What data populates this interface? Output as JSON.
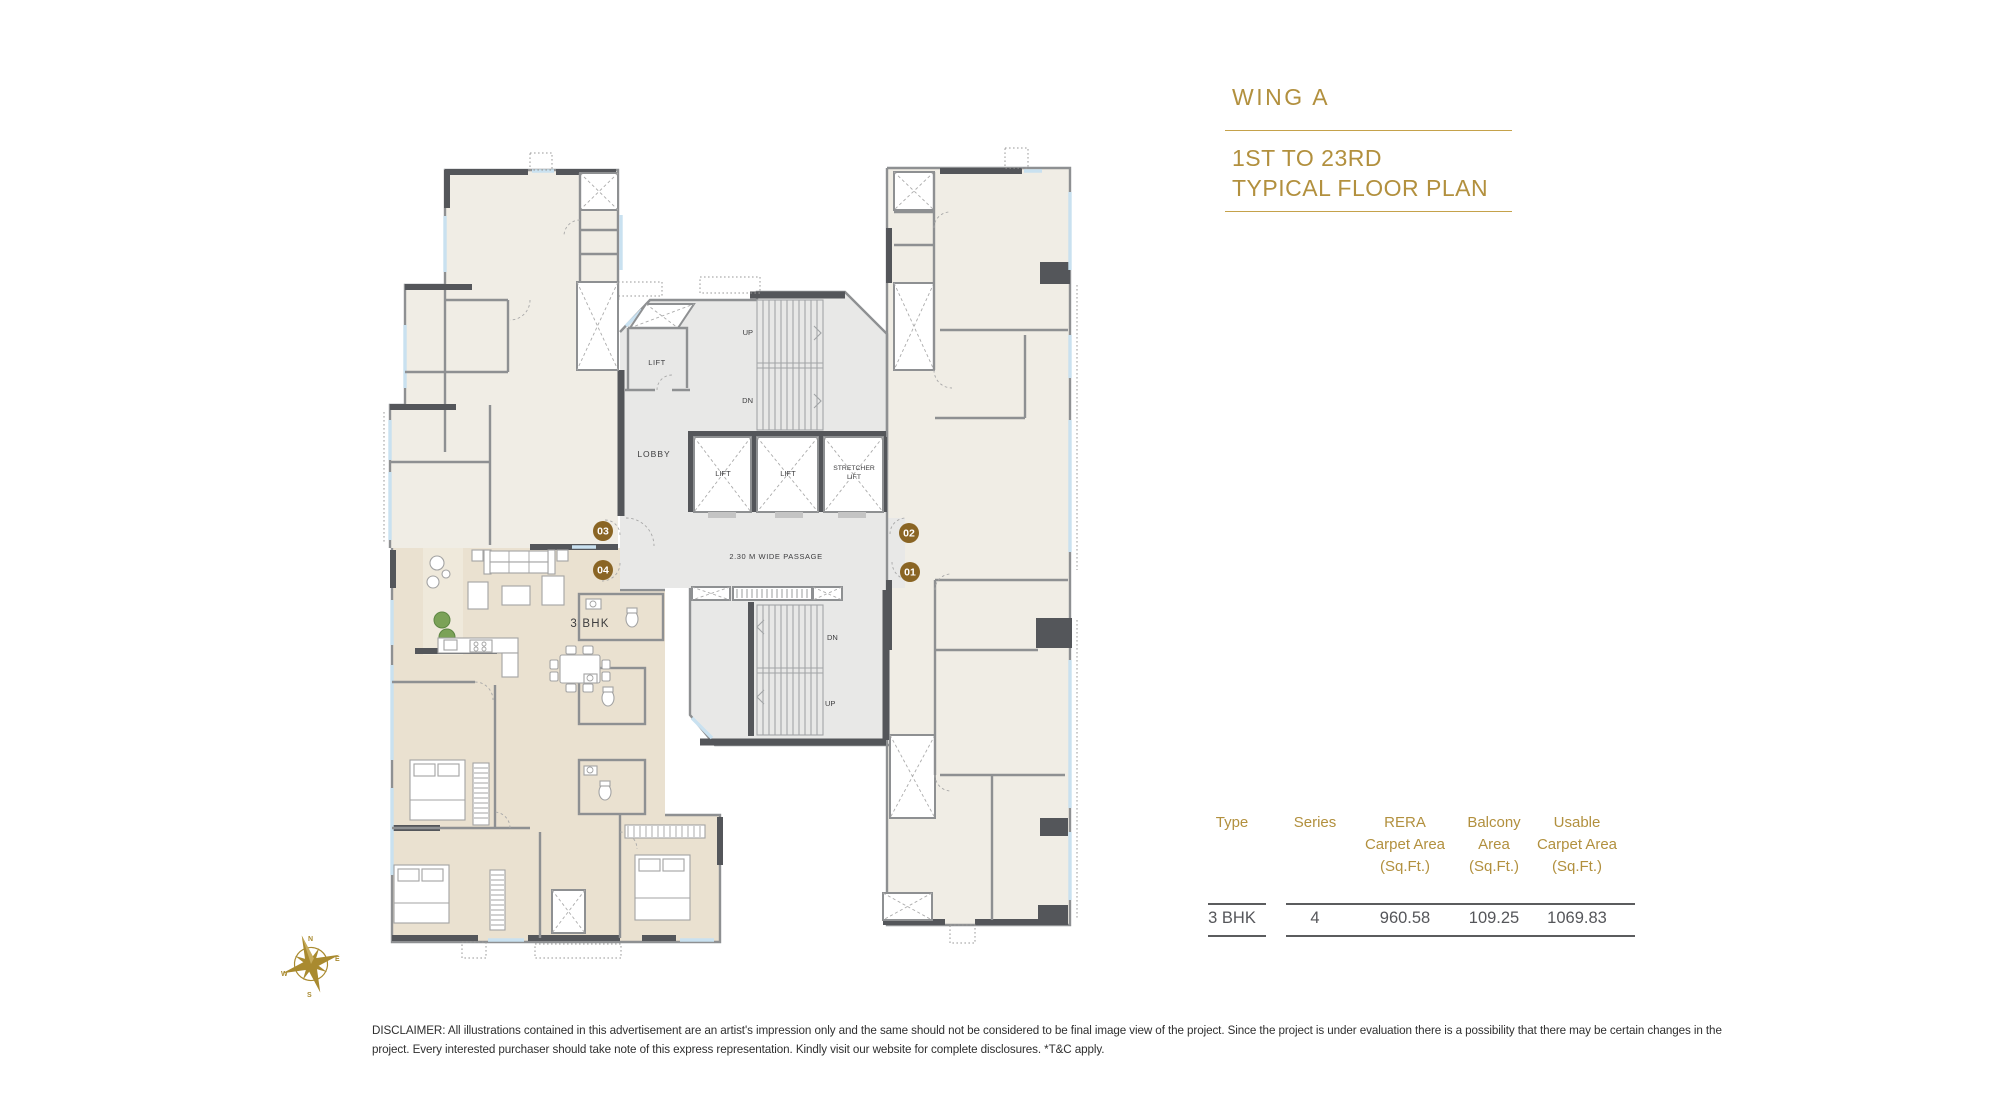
{
  "header": {
    "wing_title": "WING A",
    "subtitle_line1": "1ST TO 23RD",
    "subtitle_line2": "TYPICAL FLOOR PLAN",
    "accent_color": "#B2903E"
  },
  "plan": {
    "unit_type_label": "3 BHK",
    "passage_label": "2.30 M WIDE PASSAGE",
    "lobby_label": "LOBBY",
    "lift_room_label": "LIFT",
    "lift1_label": "LIFT",
    "lift2_label": "LIFT",
    "stretcher_lift_line1": "STRETCHER",
    "stretcher_lift_line2": "LIFT",
    "stair_top_up": "UP",
    "stair_top_dn": "DN",
    "stair_bottom_dn": "DN",
    "stair_bottom_up": "UP",
    "units": {
      "u01": "01",
      "u02": "02",
      "u03": "03",
      "u04": "04"
    },
    "unit_circle_color": "#8A6524"
  },
  "compass": {
    "n": "N",
    "e": "E",
    "s": "S",
    "w": "W"
  },
  "area_table": {
    "columns": [
      {
        "lines": [
          "Type"
        ]
      },
      {
        "lines": [
          "Series"
        ]
      },
      {
        "lines": [
          "RERA",
          "Carpet Area",
          "(Sq.Ft.)"
        ]
      },
      {
        "lines": [
          "Balcony",
          "Area",
          "(Sq.Ft.)"
        ]
      },
      {
        "lines": [
          "Usable",
          "Carpet Area",
          "(Sq.Ft.)"
        ]
      }
    ],
    "row": {
      "type": "3 BHK",
      "series": "4",
      "rera_carpet_area": "960.58",
      "balcony_area": "109.25",
      "usable_carpet_area": "1069.83"
    }
  },
  "disclaimer": {
    "line1": "DISCLAIMER: All illustrations contained in this advertisement are an artist's impression only and the same should not be considered to be final image view of the project. Since the project is under evaluation there is a possibility that there may be certain changes in the",
    "line2": "project. Every interested purchaser should take note of this express representation. Kindly visit our website for complete disclosures. *T&C apply."
  }
}
